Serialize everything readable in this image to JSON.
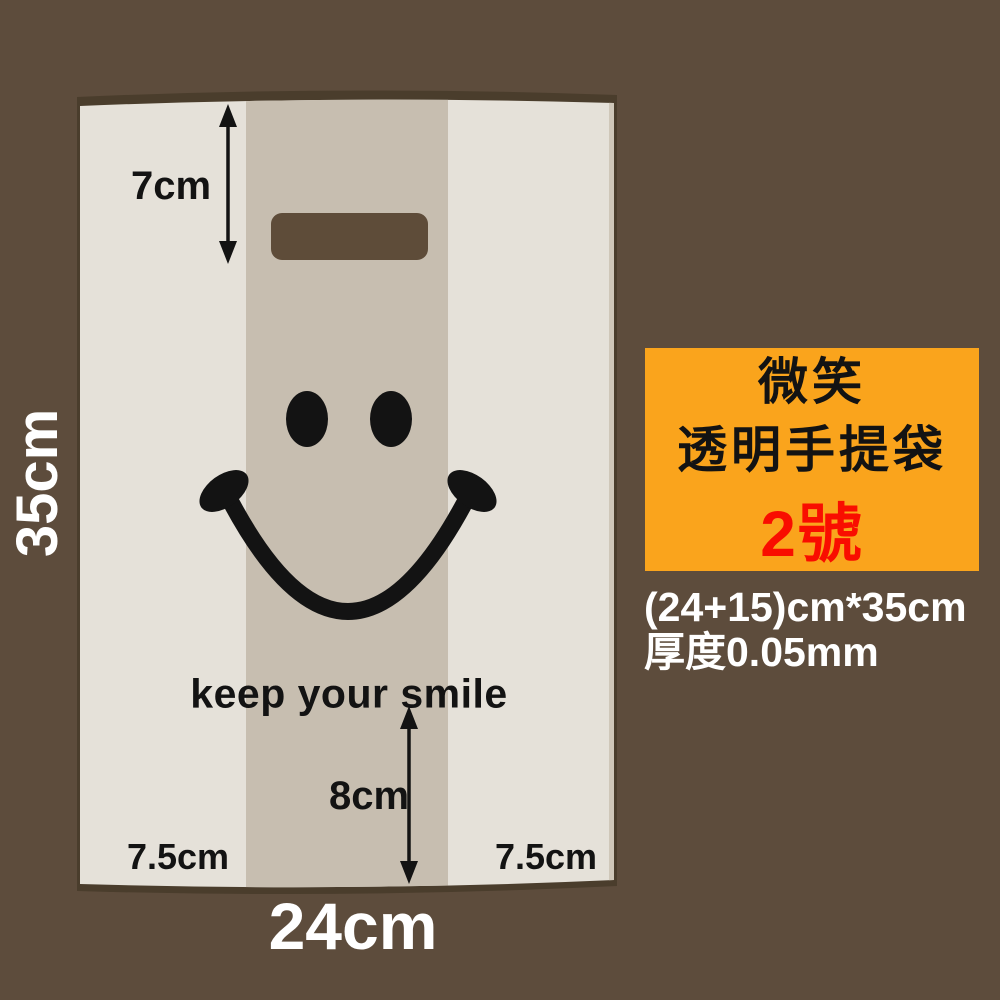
{
  "colors": {
    "background": "#5d4c3c",
    "bag_shadow": "#4a3d2c",
    "bag_body": "#e5e1d9",
    "bag_gusset": "#c7beb0",
    "bag_edge_shade": "#cfc7b9",
    "handle_hole": "#5e4c39",
    "print": "#131313",
    "annotation": "#131313"
  },
  "bag": {
    "slogan": "keep your smile"
  },
  "dimensions": {
    "handle_height": "7cm",
    "bag_height": "35cm",
    "bottom_gusset": "8cm",
    "side_gusset_left": "7.5cm",
    "side_gusset_right": "7.5cm",
    "bag_width": "24cm"
  },
  "product_card": {
    "background_color": "#faa41c",
    "title_line1": "微笑",
    "title_line2": "透明手提袋",
    "size_label": "2號",
    "size_color": "#f90d00"
  },
  "specs": {
    "size_text": "(24+15)cm*35cm",
    "thickness_text": "厚度0.05mm"
  }
}
